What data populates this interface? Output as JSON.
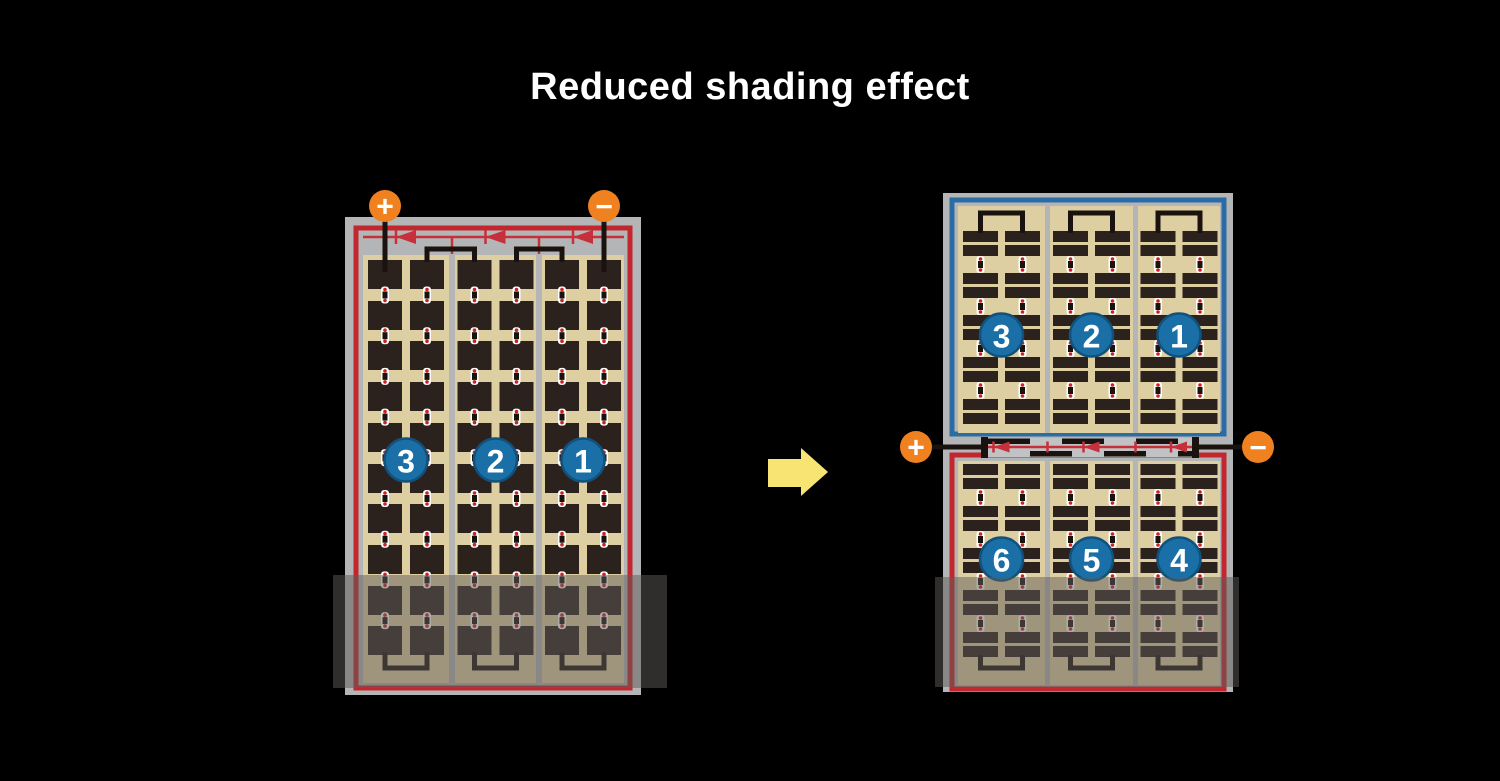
{
  "title": "Reduced shading effect",
  "colors": {
    "background": "#000000",
    "title_text": "#ffffff",
    "frame_gray": "#b4b5b7",
    "busbar_gray": "#c0c2c3",
    "panel_tan": "#ddcfa1",
    "cell_dark": "#2b211d",
    "wire_black": "#1a120e",
    "border_red": "#c1272d",
    "diode_red": "#c5303a",
    "border_blue": "#2b6ca3",
    "circle_blue": "#1a6fa6",
    "circle_blue_edge": "#12517c",
    "terminal_orange": "#ef8120",
    "terminal_symbol": "#ffffff",
    "arrow_yellow": "#f8e472",
    "shade_overlay": "rgba(95,92,88,0.5)",
    "dot_white": "#ffffff",
    "dot_red": "#cc2222"
  },
  "left_module": {
    "terminals": [
      {
        "symbol": "+"
      },
      {
        "symbol": "−"
      }
    ],
    "cell_strings": [
      {
        "label": "3"
      },
      {
        "label": "2"
      },
      {
        "label": "1"
      }
    ],
    "diode_count": 3,
    "shaded": true
  },
  "right_module": {
    "terminals": [
      {
        "symbol": "+"
      },
      {
        "symbol": "−"
      }
    ],
    "top_half": {
      "cell_strings": [
        {
          "label": "3"
        },
        {
          "label": "2"
        },
        {
          "label": "1"
        }
      ]
    },
    "bottom_half": {
      "cell_strings": [
        {
          "label": "6"
        },
        {
          "label": "5"
        },
        {
          "label": "4"
        }
      ]
    },
    "diode_count": 3,
    "shaded": true
  },
  "arrow": {
    "direction": "right"
  }
}
